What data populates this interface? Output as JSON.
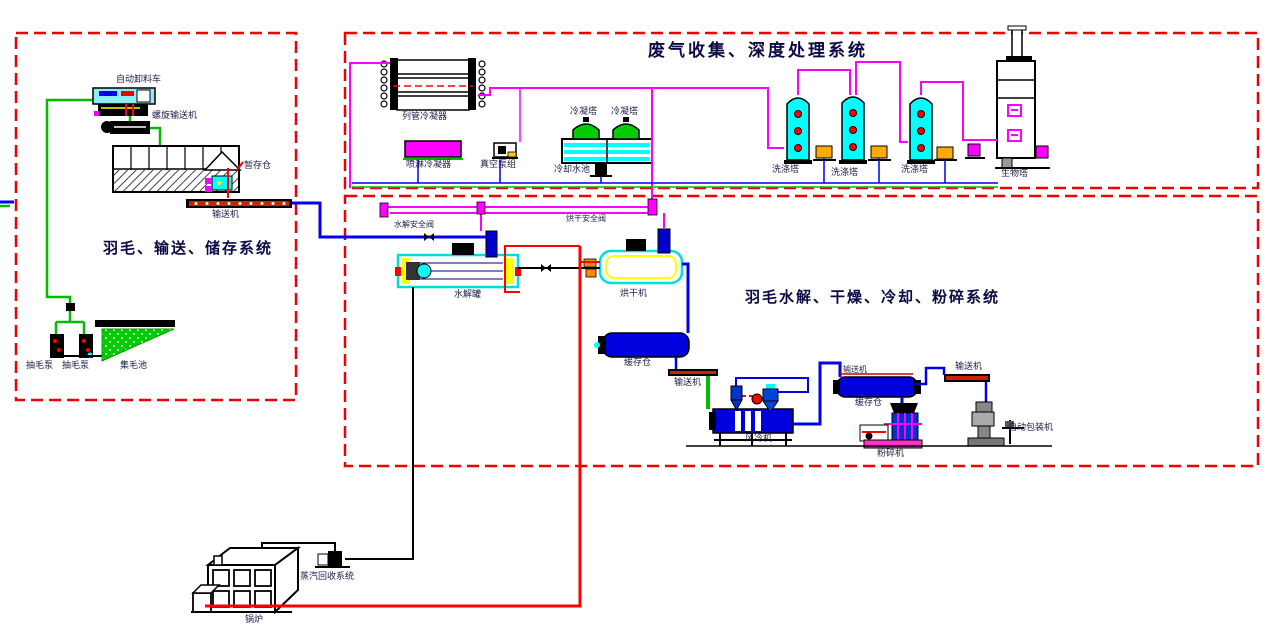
{
  "titles": {
    "gas_system": "废气收集、深度处理系统",
    "hydrolysis_system": "羽毛水解、干燥、冷却、粉碎系统",
    "feather_system": "羽毛、输送、储存系统"
  },
  "labels": {
    "auto_unloader": "自动卸料车",
    "screw_conveyor": "螺旋输送机",
    "buffer_bin_left": "暂存仓",
    "conveyor_left": "输送机",
    "feather_pump_1": "抽毛泵",
    "feather_pump_2": "抽毛泵",
    "feather_pool": "集毛池",
    "tube_condenser": "列管冷凝器",
    "spray_condenser": "喷淋冷凝器",
    "vacuum_pump": "真空泵组",
    "cond_tower_1": "冷凝塔",
    "cond_tower_2": "冷凝塔",
    "cooling_pool": "冷却水池",
    "scrubber_1": "洗涤塔",
    "scrubber_2": "洗涤塔",
    "scrubber_3": "洗涤塔",
    "bio_tower": "生物塔",
    "hydrolysis_valve": "水解安全阀",
    "dryer_valve": "烘干安全阀",
    "hydrolysis_tank": "水解罐",
    "dryer": "烘干机",
    "buffer_bin_1": "缓存仓",
    "conveyor_1": "输送机",
    "air_cooler": "风冷机",
    "conveyor_2": "输送机",
    "buffer_bin_2": "缓存仓",
    "conveyor_3": "输送机",
    "crusher": "粉碎机",
    "packer": "自动包装机",
    "steam_recovery": "蒸汽回收系统",
    "boiler": "锅炉"
  },
  "colors": {
    "boundary_red": "#ee0000",
    "pipe_green": "#00bb00",
    "pipe_blue": "#0000ee",
    "pipe_magenta": "#ff00ff",
    "pipe_red": "#ff0000",
    "pipe_black": "#000000",
    "scrubber_cyan": "#00ffff",
    "tower_green": "#00cc00",
    "vessel_blue": "#0000dd",
    "pump_orange": "#ffaa00"
  }
}
